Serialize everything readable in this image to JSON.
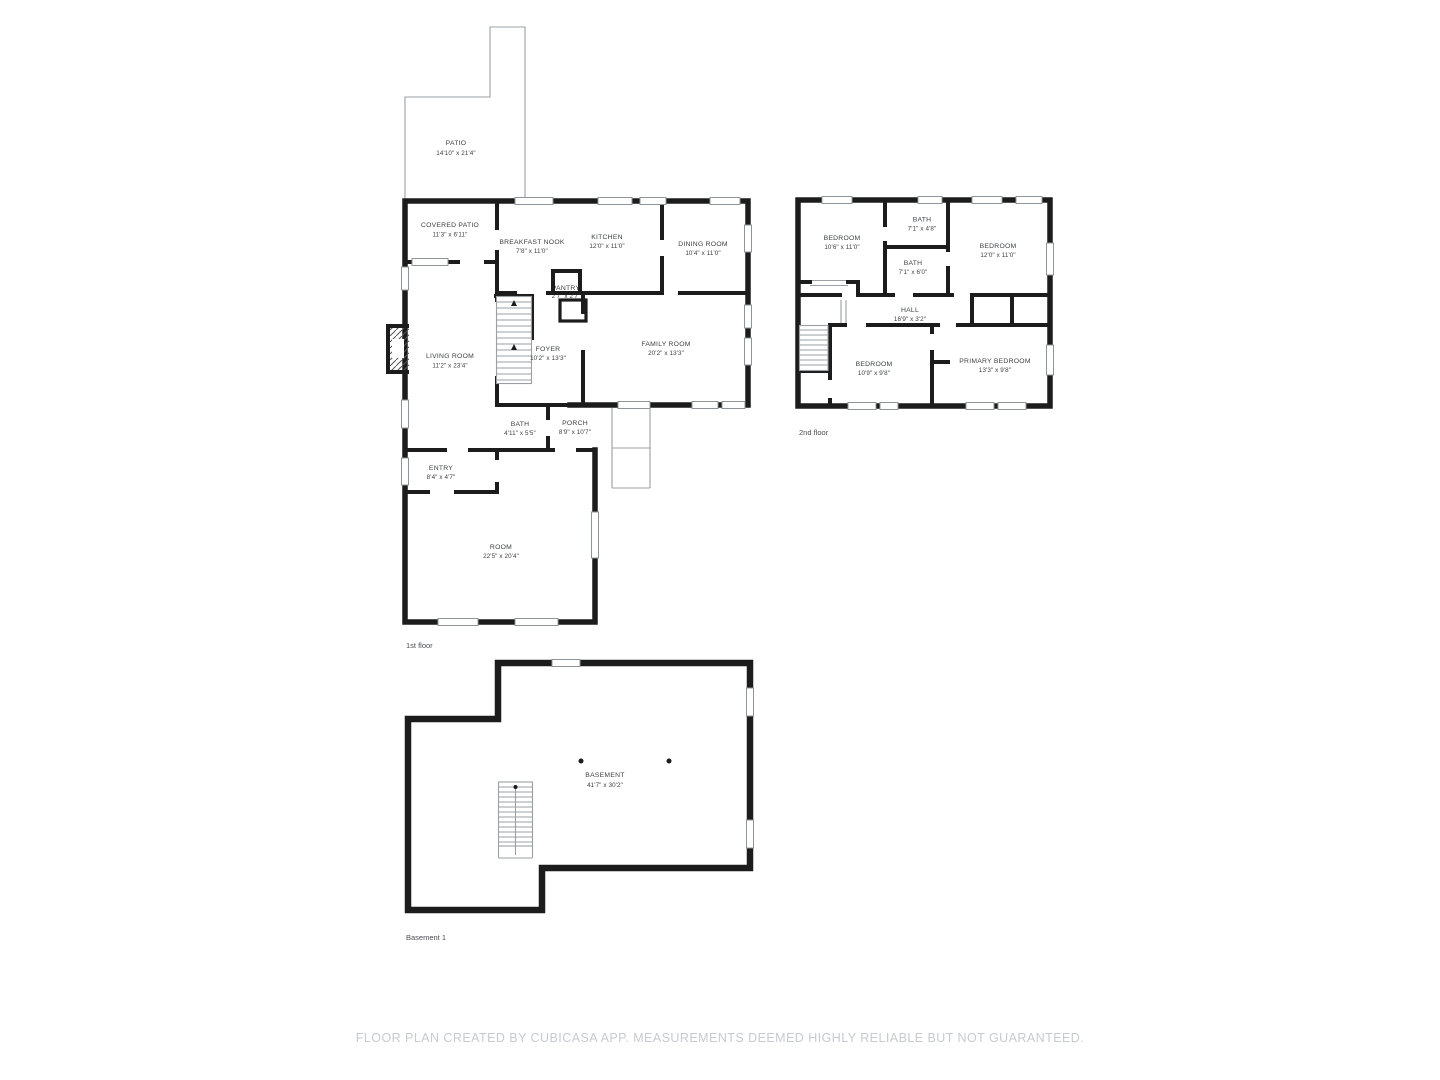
{
  "colors": {
    "wall": "#1c1c1c",
    "label": "#3d3f42",
    "sublabel": "#4b4d50",
    "thin": "#9aa0a4",
    "win": "#8e9499",
    "footer": "#c6cbcf"
  },
  "floors": {
    "first": {
      "label": "1st floor",
      "rooms": {
        "patio": {
          "name": "PATIO",
          "dims": "14'10\" x 21'4\""
        },
        "covered_patio": {
          "name": "COVERED PATIO",
          "dims": "11'3\" x 6'11\""
        },
        "breakfast_nook": {
          "name": "BREAKFAST NOOK",
          "dims": "7'8\" x 11'0\""
        },
        "kitchen": {
          "name": "KITCHEN",
          "dims": "12'0\" x 11'0\""
        },
        "dining_room": {
          "name": "DINING ROOM",
          "dims": "10'4\" x 11'0\""
        },
        "pantry": {
          "name": "PANTRY",
          "dims": "2'7\" x 2'7\""
        },
        "living_room": {
          "name": "LIVING ROOM",
          "dims": "11'2\" x 23'4\""
        },
        "foyer": {
          "name": "FOYER",
          "dims": "10'2\" x 13'3\""
        },
        "family_room": {
          "name": "FAMILY ROOM",
          "dims": "20'2\" x 13'3\""
        },
        "bath": {
          "name": "BATH",
          "dims": "4'11\" x 5'5\""
        },
        "porch": {
          "name": "PORCH",
          "dims": "8'9\" x 10'7\""
        },
        "entry": {
          "name": "ENTRY",
          "dims": "8'4\" x 4'7\""
        },
        "room": {
          "name": "ROOM",
          "dims": "22'5\" x 20'4\""
        }
      }
    },
    "second": {
      "label": "2nd floor",
      "rooms": {
        "bedroom_1": {
          "name": "BEDROOM",
          "dims": "10'6\" x 11'0\""
        },
        "bath_1": {
          "name": "BATH",
          "dims": "7'1\" x 4'8\""
        },
        "bedroom_2": {
          "name": "BEDROOM",
          "dims": "12'0\" x 11'0\""
        },
        "bath_2": {
          "name": "BATH",
          "dims": "7'1\" x 6'0\""
        },
        "hall": {
          "name": "HALL",
          "dims": "16'9\" x 3'2\""
        },
        "bedroom_3": {
          "name": "BEDROOM",
          "dims": "10'9\" x 9'8\""
        },
        "primary_bedroom": {
          "name": "PRIMARY BEDROOM",
          "dims": "13'3\" x 9'8\""
        }
      }
    },
    "basement": {
      "label": "Basement 1",
      "rooms": {
        "basement": {
          "name": "BASEMENT",
          "dims": "41'7\" x 30'2\""
        }
      }
    }
  },
  "footer": {
    "disclaimer": "FLOOR PLAN CREATED BY CUBICASA APP. MEASUREMENTS DEEMED HIGHLY RELIABLE BUT NOT GUARANTEED."
  }
}
